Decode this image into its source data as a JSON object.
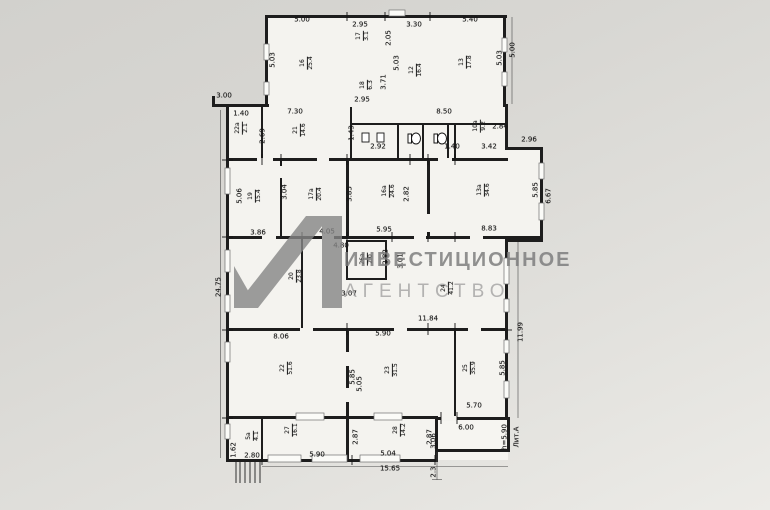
{
  "document": {
    "type": "scanned floor plan (BTI technical plan)",
    "building_label": "Лит.А",
    "height_note": "h=5.90"
  },
  "colors": {
    "paper": "#d8d7d3",
    "room_fill": "#f4f3ef",
    "wall": "#1d1d1d",
    "watermark_gray": "#8a8a8a"
  },
  "watermark": {
    "logo_icon": "a1-triangle-logo",
    "line1": "ИНВЕСТИЦИОННОЕ",
    "line2": "АГЕНТСТВО"
  },
  "icons": [
    {
      "name": "toilet-icon",
      "meaning": "WC toilet symbol"
    },
    {
      "name": "sink-icon",
      "meaning": "washbasin symbol"
    },
    {
      "name": "stairs-hatch-icon",
      "meaning": "exterior stair hatch marks"
    }
  ],
  "floorplan": {
    "dimension_labels": [
      {
        "text": "5.00",
        "x": 302,
        "y": 20
      },
      {
        "text": "2.95",
        "x": 360,
        "y": 25
      },
      {
        "text": "3.30",
        "x": 414,
        "y": 25
      },
      {
        "text": "5.40",
        "x": 470,
        "y": 20
      },
      {
        "text": "3.00",
        "x": 224,
        "y": 96
      },
      {
        "text": "1.40",
        "x": 241,
        "y": 114
      },
      {
        "text": "7.30",
        "x": 295,
        "y": 112
      },
      {
        "text": "8.50",
        "x": 444,
        "y": 112
      },
      {
        "text": "2.95",
        "x": 362,
        "y": 100
      },
      {
        "text": "2.92",
        "x": 378,
        "y": 147
      },
      {
        "text": "1.40",
        "x": 452,
        "y": 147
      },
      {
        "text": "3.42",
        "x": 489,
        "y": 147
      },
      {
        "text": "2.84",
        "x": 500,
        "y": 127
      },
      {
        "text": "2.96",
        "x": 529,
        "y": 140
      },
      {
        "text": "3.86",
        "x": 258,
        "y": 233
      },
      {
        "text": "4.05",
        "x": 327,
        "y": 232
      },
      {
        "text": "5.95",
        "x": 384,
        "y": 230
      },
      {
        "text": "8.83",
        "x": 489,
        "y": 229
      },
      {
        "text": "4.80",
        "x": 341,
        "y": 246
      },
      {
        "text": "3.07",
        "x": 349,
        "y": 294
      },
      {
        "text": "11.84",
        "x": 428,
        "y": 319
      },
      {
        "text": "8.06",
        "x": 281,
        "y": 337
      },
      {
        "text": "5.90",
        "x": 383,
        "y": 334
      },
      {
        "text": "5.70",
        "x": 474,
        "y": 406
      },
      {
        "text": "6.00",
        "x": 466,
        "y": 428
      },
      {
        "text": "2.80",
        "x": 252,
        "y": 456
      },
      {
        "text": "5.90",
        "x": 317,
        "y": 455
      },
      {
        "text": "5.04",
        "x": 388,
        "y": 454
      },
      {
        "text": "15.65",
        "x": 390,
        "y": 469
      },
      {
        "text": "5.03",
        "x": 273,
        "y": 60,
        "v": true
      },
      {
        "text": "2.05",
        "x": 389,
        "y": 38,
        "v": true
      },
      {
        "text": "3.71",
        "x": 384,
        "y": 82,
        "v": true
      },
      {
        "text": "5.03",
        "x": 397,
        "y": 63,
        "v": true
      },
      {
        "text": "5.03",
        "x": 500,
        "y": 58,
        "v": true
      },
      {
        "text": "5.00",
        "x": 513,
        "y": 50,
        "v": true
      },
      {
        "text": "2.69",
        "x": 263,
        "y": 136,
        "v": true
      },
      {
        "text": "1.43",
        "x": 352,
        "y": 133,
        "v": true
      },
      {
        "text": "5.06",
        "x": 240,
        "y": 196,
        "v": true
      },
      {
        "text": "3.04",
        "x": 285,
        "y": 192,
        "v": true
      },
      {
        "text": "3.85",
        "x": 350,
        "y": 194,
        "v": true
      },
      {
        "text": "2.82",
        "x": 407,
        "y": 194,
        "v": true
      },
      {
        "text": "5.85",
        "x": 536,
        "y": 190,
        "v": true
      },
      {
        "text": "6.67",
        "x": 549,
        "y": 196,
        "v": true
      },
      {
        "text": "24.75",
        "x": 219,
        "y": 287,
        "v": true
      },
      {
        "text": "2.82",
        "x": 386,
        "y": 257,
        "v": true
      },
      {
        "text": "3.01",
        "x": 401,
        "y": 261,
        "v": true
      },
      {
        "text": "11.99",
        "x": 521,
        "y": 332,
        "v": true
      },
      {
        "text": "5.85",
        "x": 353,
        "y": 377,
        "v": true
      },
      {
        "text": "5.05",
        "x": 360,
        "y": 384,
        "v": true
      },
      {
        "text": "5.85",
        "x": 503,
        "y": 368,
        "v": true
      },
      {
        "text": "2.87",
        "x": 356,
        "y": 437,
        "v": true
      },
      {
        "text": "2.87",
        "x": 430,
        "y": 437,
        "v": true
      },
      {
        "text": "1.62",
        "x": 234,
        "y": 450,
        "v": true
      },
      {
        "text": "3.06",
        "x": 434,
        "y": 441,
        "v": true
      },
      {
        "text": "2.3",
        "x": 434,
        "y": 472,
        "v": true
      },
      {
        "text": "h=5.90",
        "x": 505,
        "y": 437,
        "v": true
      },
      {
        "text": "Лит.А",
        "x": 517,
        "y": 437,
        "v": true
      }
    ],
    "room_labels": [
      {
        "number": "16",
        "area": "25.4",
        "x": 307,
        "y": 63
      },
      {
        "number": "17",
        "area": "3.1",
        "x": 363,
        "y": 36
      },
      {
        "number": "18",
        "area": "6.3",
        "x": 367,
        "y": 85
      },
      {
        "number": "12",
        "area": "16.4",
        "x": 416,
        "y": 70
      },
      {
        "number": "13",
        "area": "17.8",
        "x": 466,
        "y": 62
      },
      {
        "number": "22а",
        "area": "2.1",
        "x": 242,
        "y": 128
      },
      {
        "number": "21",
        "area": "14.6",
        "x": 300,
        "y": 130
      },
      {
        "number": "10а",
        "area": "9.2",
        "x": 480,
        "y": 126
      },
      {
        "number": "19",
        "area": "15.4",
        "x": 255,
        "y": 196
      },
      {
        "number": "17а",
        "area": "20.4",
        "x": 316,
        "y": 194
      },
      {
        "number": "16а",
        "area": "24.6",
        "x": 389,
        "y": 191
      },
      {
        "number": "13а",
        "area": "34.6",
        "x": 484,
        "y": 190
      },
      {
        "number": "20",
        "area": "23.8",
        "x": 296,
        "y": 276
      },
      {
        "number": "26а",
        "area": "2.0",
        "x": 367,
        "y": 259
      },
      {
        "number": "24",
        "area": "41.2",
        "x": 448,
        "y": 288
      },
      {
        "number": "22",
        "area": "51.6",
        "x": 287,
        "y": 368
      },
      {
        "number": "23",
        "area": "31.5",
        "x": 392,
        "y": 370
      },
      {
        "number": "25",
        "area": "35.9",
        "x": 470,
        "y": 368
      },
      {
        "number": "5а",
        "area": "4.1",
        "x": 253,
        "y": 436
      },
      {
        "number": "27",
        "area": "16.1",
        "x": 292,
        "y": 430
      },
      {
        "number": "28",
        "area": "14.2",
        "x": 400,
        "y": 430
      }
    ]
  }
}
